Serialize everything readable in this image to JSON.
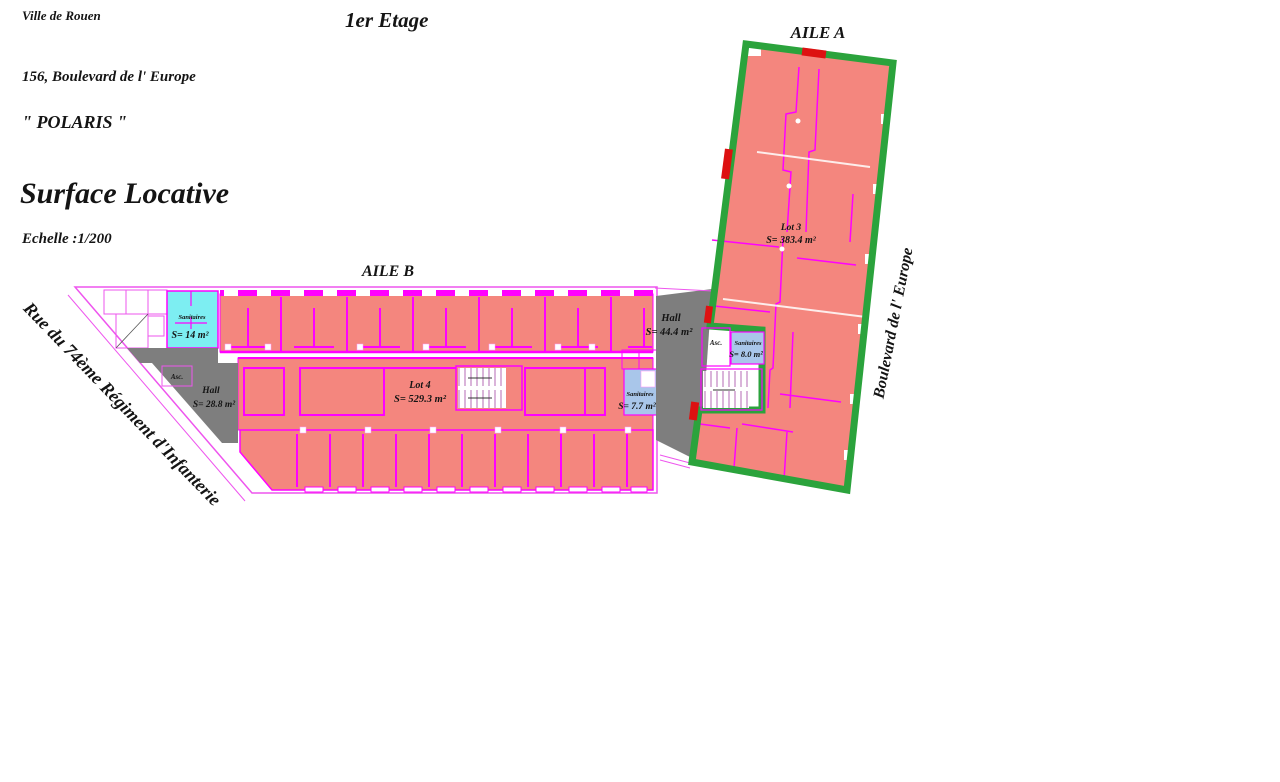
{
  "document": {
    "city": "Ville de Rouen",
    "floor_title": "1er Etage",
    "address": "156, Boulevard de l' Europe",
    "building_name": "\" POLARIS \"",
    "plan_title": "Surface Locative",
    "scale": "Echelle :1/200"
  },
  "streets": {
    "left_street": "Rue du 74ème Régiment d'Infanterie",
    "right_street": "Boulevard de l' Europe"
  },
  "aile_a": {
    "label": "AILE A",
    "lot": {
      "name": "Lot 3",
      "area": "S= 383.4 m²"
    },
    "hall": {
      "name": "Hall",
      "area": "S= 44.4 m²"
    },
    "sanitaires": {
      "name": "Sanitaires",
      "area": "S= 8.0 m²"
    },
    "elevator": "Asc."
  },
  "aile_b": {
    "label": "AILE B",
    "lot": {
      "name": "Lot 4",
      "area": "S= 529.3 m²"
    },
    "hall": {
      "name": "Hall",
      "area": "S= 28.8 m²"
    },
    "sanitaires_left": {
      "name": "Sanitaires",
      "area": "S= 14 m²"
    },
    "sanitaires_right": {
      "name": "Sanitaires",
      "area": "S= 7.7 m²"
    },
    "elevator": "Asc."
  },
  "legend_colors": {
    "rentable_pink": "#f4867e",
    "wall_magenta": "#ff00ff",
    "boundary_green": "#2ba33c",
    "common_gray": "#7e7e7e",
    "sanitary_cyan": "#7deef2",
    "sanitary_blue": "#a9c6ea",
    "door_red": "#dd1111"
  }
}
